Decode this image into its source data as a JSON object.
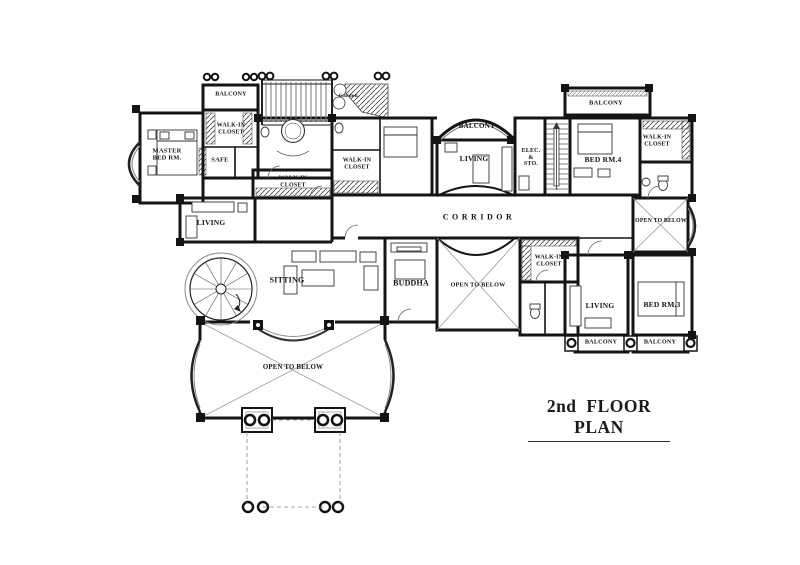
{
  "title": "2nd FLOOR PLAN",
  "labels": {
    "balcony_top_left": "BALCONY",
    "walkin_closet_nw": "WALK-IN\nCLOSET",
    "master_bed_rm": "MASTER\nBED RM.",
    "safe": "SAFE",
    "walkin_closet_master": "WALK-IN\nCLOSET",
    "garden": "Garden.",
    "walkin_closet_center": "WALK-IN\nCLOSET",
    "balcony_center": "BALCONY",
    "living_center": "LIVING",
    "elec_sto": "ELEC.\n&\nSTO.",
    "bed_rm_4": "BED RM.4",
    "walkin_closet_ne": "WALK-IN\nCLOSET",
    "balcony_top_right": "BALCONY",
    "corridor": "CORRIDOR",
    "open_to_below_right": "OPEN TO BELOW",
    "living_left": "LIVING",
    "sitting": "SITTING",
    "buddha": "BUDDHA",
    "open_to_below_center": "OPEN TO BELOW",
    "walkin_closet_hall": "WALK-IN\nCLOSET",
    "living_right": "LIVING",
    "bed_rm_3": "BED RM.3",
    "balcony_bottom_1": "BALCONY",
    "balcony_bottom_2": "BALCONY",
    "open_to_below_bottom": "OPEN TO BELOW"
  }
}
